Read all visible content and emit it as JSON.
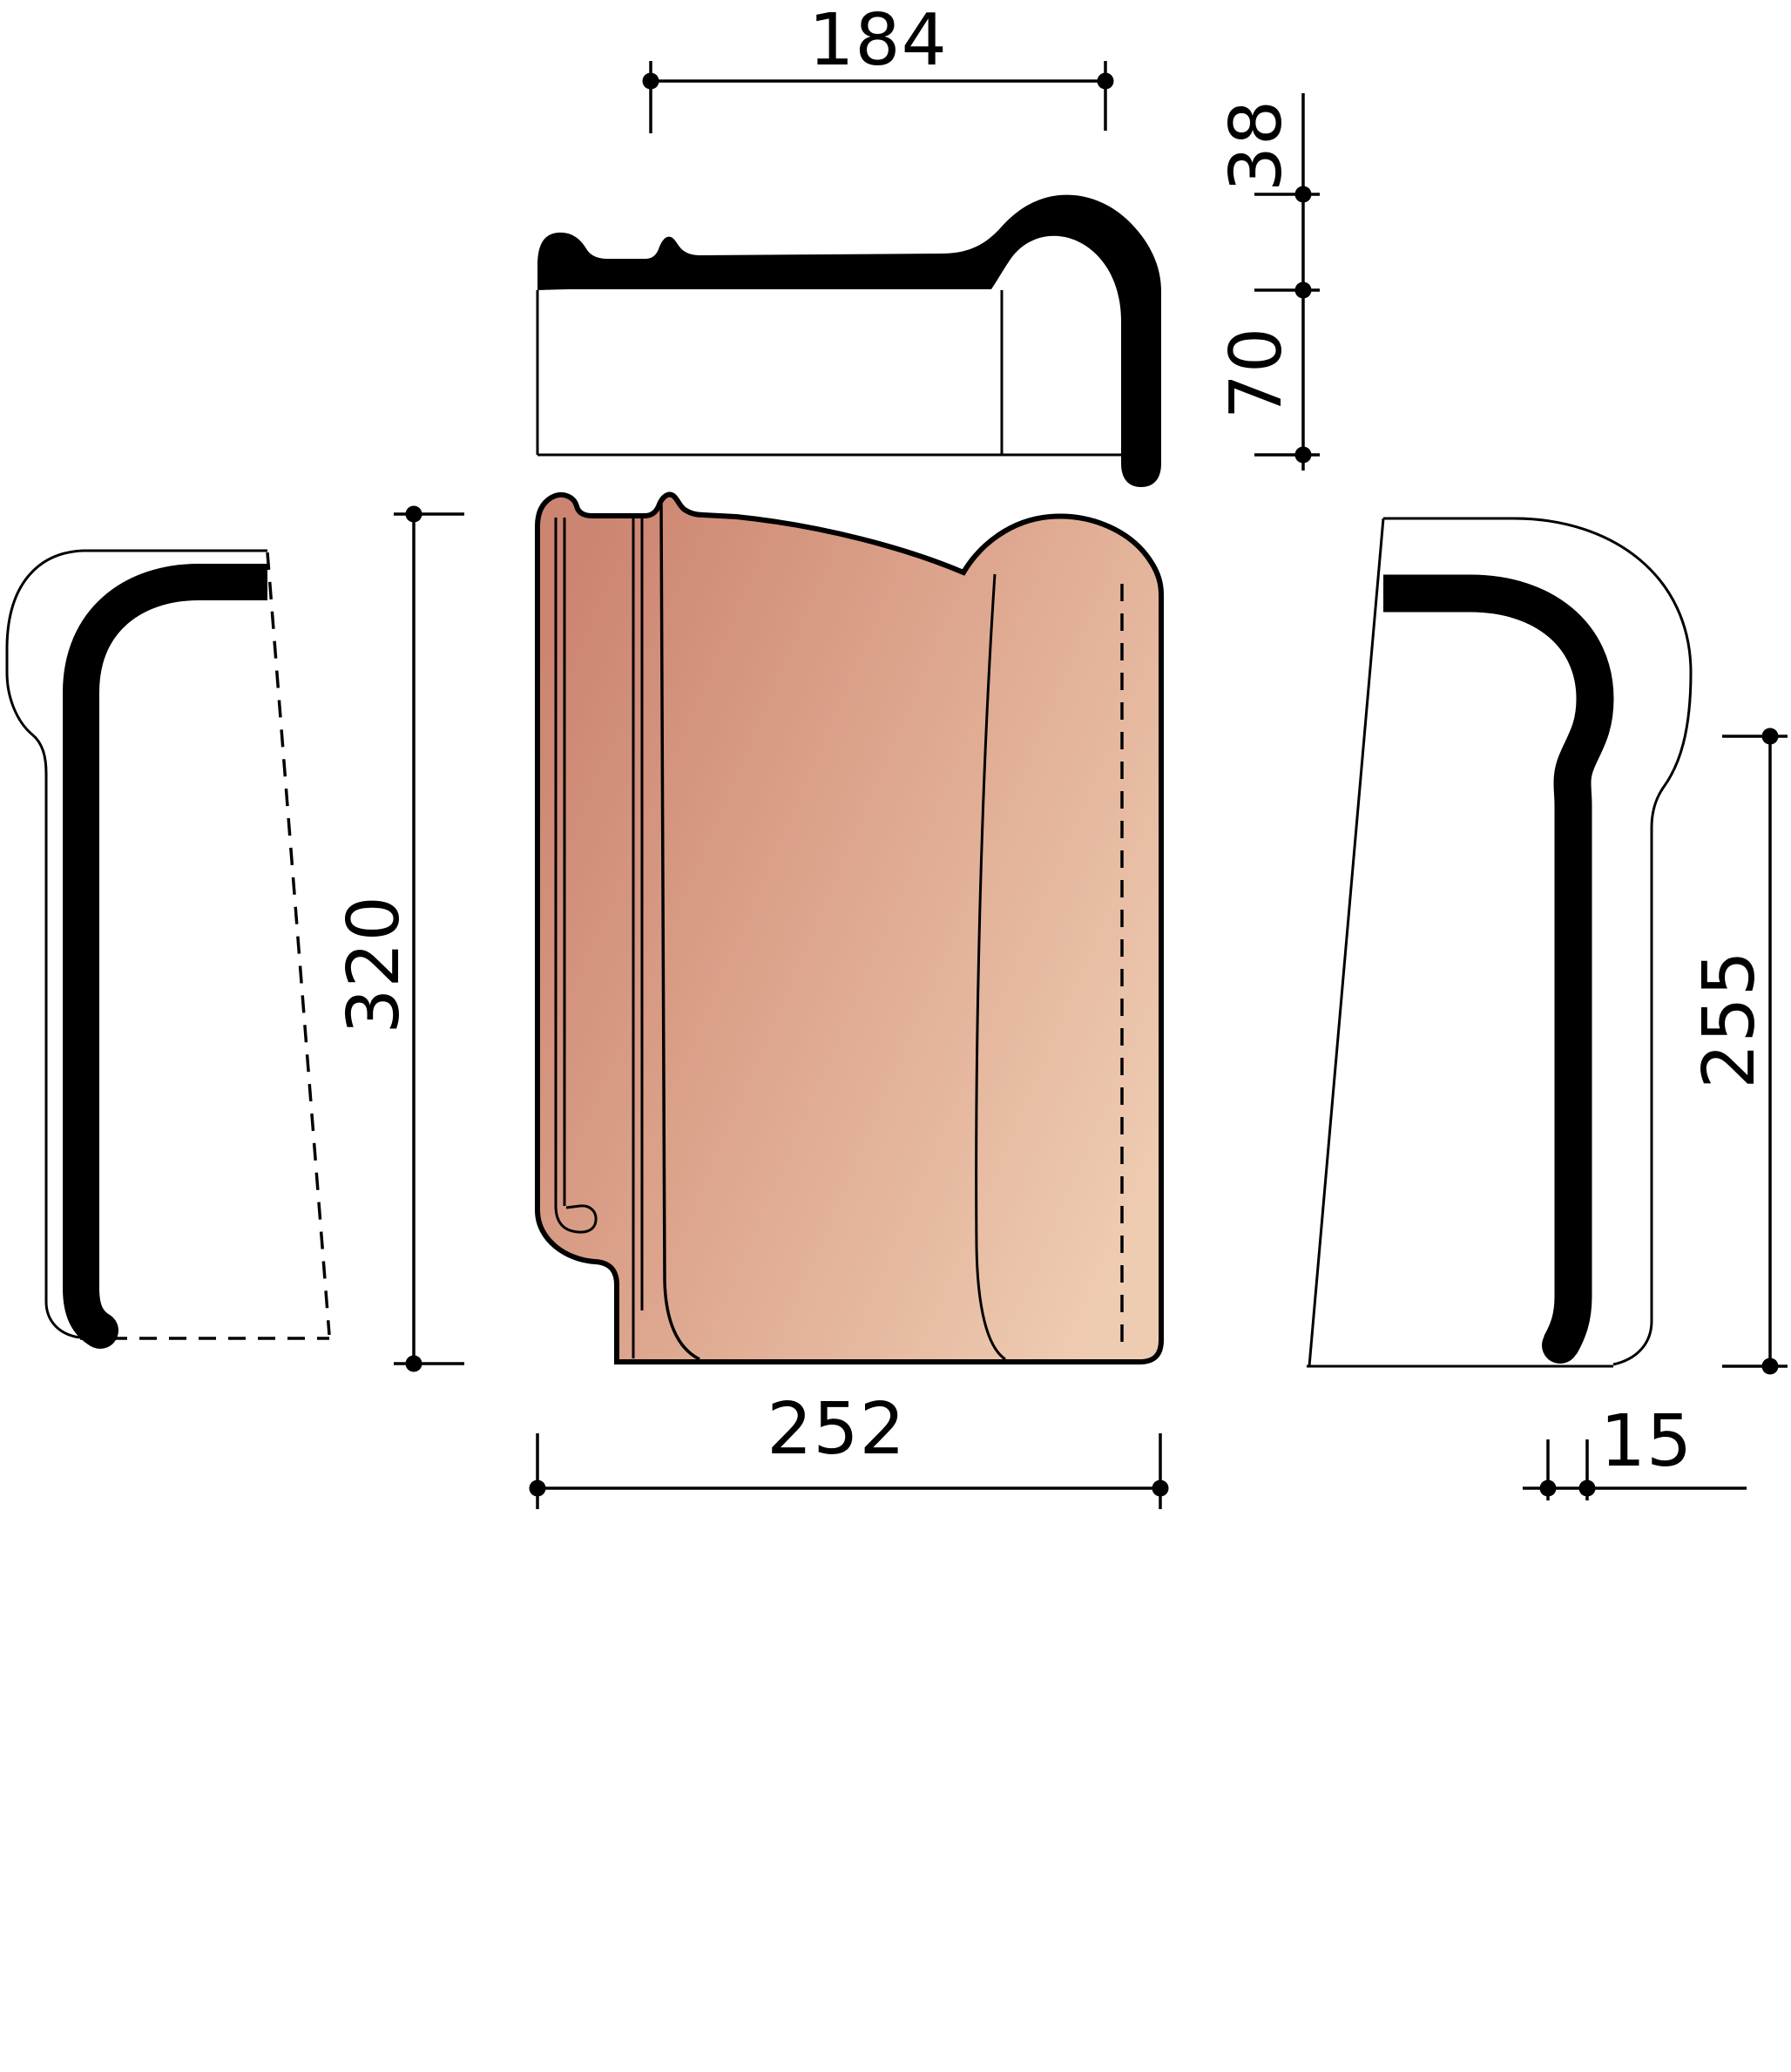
{
  "drawing": {
    "type": "technical-drawing-roof-tile",
    "background_color": "#ffffff",
    "line_color": "#000000",
    "tile_colors": {
      "dark": "#cc8571",
      "mid": "#dda58d",
      "light": "#eeccb2"
    },
    "views": {
      "top_profile": {
        "name": "top profile section"
      },
      "front": {
        "name": "front view"
      },
      "left_side": {
        "name": "left side view"
      },
      "right_side": {
        "name": "right side view"
      }
    },
    "dimensions": {
      "cover_width": {
        "label": "184"
      },
      "hook_height": {
        "label": "38"
      },
      "head_depth": {
        "label": "70"
      },
      "length": {
        "label": "320"
      },
      "width": {
        "label": "252"
      },
      "side_height": {
        "label": "255"
      },
      "thickness": {
        "label": "15"
      }
    }
  }
}
